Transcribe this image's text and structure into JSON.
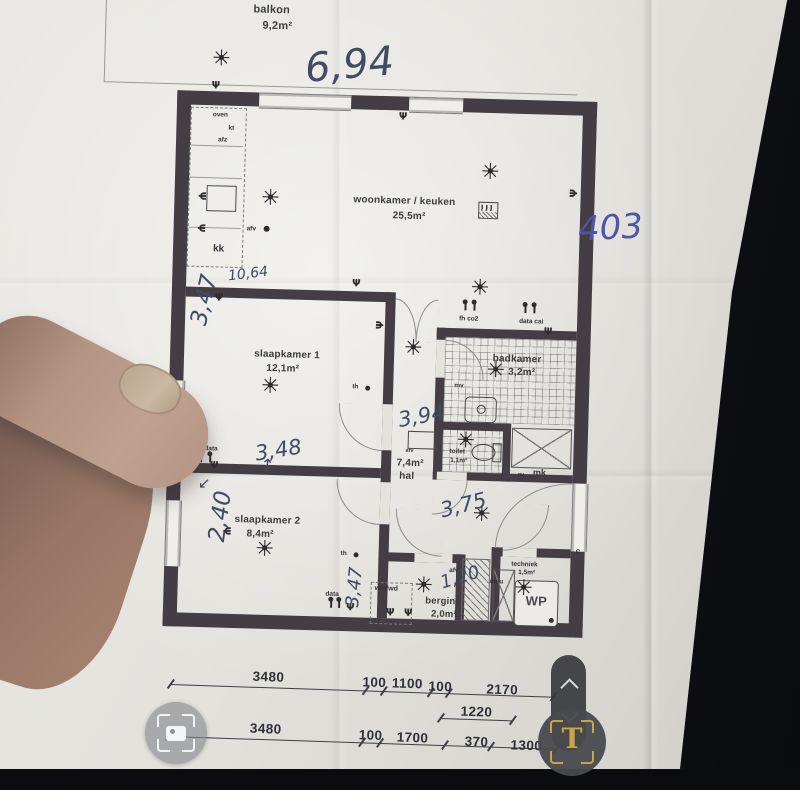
{
  "balcony": {
    "label": "balkon",
    "area": "9,2m²"
  },
  "rooms": [
    {
      "label": "woonkamer / keuken",
      "area": "25,5m²"
    },
    {
      "label": "slaapkamer 1",
      "area": "12,1m²"
    },
    {
      "label": "badkamer",
      "area": "3,2m²"
    },
    {
      "label": "hal",
      "area": "7,4m²"
    },
    {
      "label": "toilet",
      "area": "1,1m²"
    },
    {
      "label": "slaapkamer 2",
      "area": "8,4m²"
    },
    {
      "label": "berging",
      "area": "2,0m²"
    },
    {
      "label": "techniek",
      "area": "1,5m²"
    }
  ],
  "fixtures": {
    "oven": "oven",
    "kt": "kt",
    "afz": "afz",
    "kk": "kk",
    "afv": "afv",
    "wp": "WP",
    "wm_wd": "wm/wd",
    "mk": "mk",
    "pv": "pv",
    "mvu": "mvu",
    "th": "th",
    "mv": "mv",
    "fh_co2": "fh co2",
    "data_cai": "data cai",
    "cai_data": "cai data",
    "data": "data",
    "c": "c"
  },
  "dimensions": {
    "row1": [
      "3480",
      "100",
      "1100",
      "100",
      "2170"
    ],
    "mid": "1220",
    "row2": [
      "3480",
      "100",
      "1700",
      "370",
      "1300"
    ]
  },
  "annotations": {
    "top_width": "6,94",
    "apartment_number": "403",
    "total_width": "10,64",
    "s1_height": "3,47",
    "s1_width": "3,48",
    "s2_height": "2,40",
    "hal_height": "3,94",
    "hal_width": "3,75",
    "berging_width": "1,20",
    "berging_height": "3,47",
    "s1_width_arrow": "↑",
    "s2_arrow": "↙"
  },
  "overlay": {
    "translate_letter": "T"
  },
  "colors": {
    "wall": "#443d44",
    "pencil_ink": "#414b63",
    "pen_ink": "#4c55a6",
    "overlay_gold": "#c9a545",
    "paper": "#e4e2dd"
  }
}
